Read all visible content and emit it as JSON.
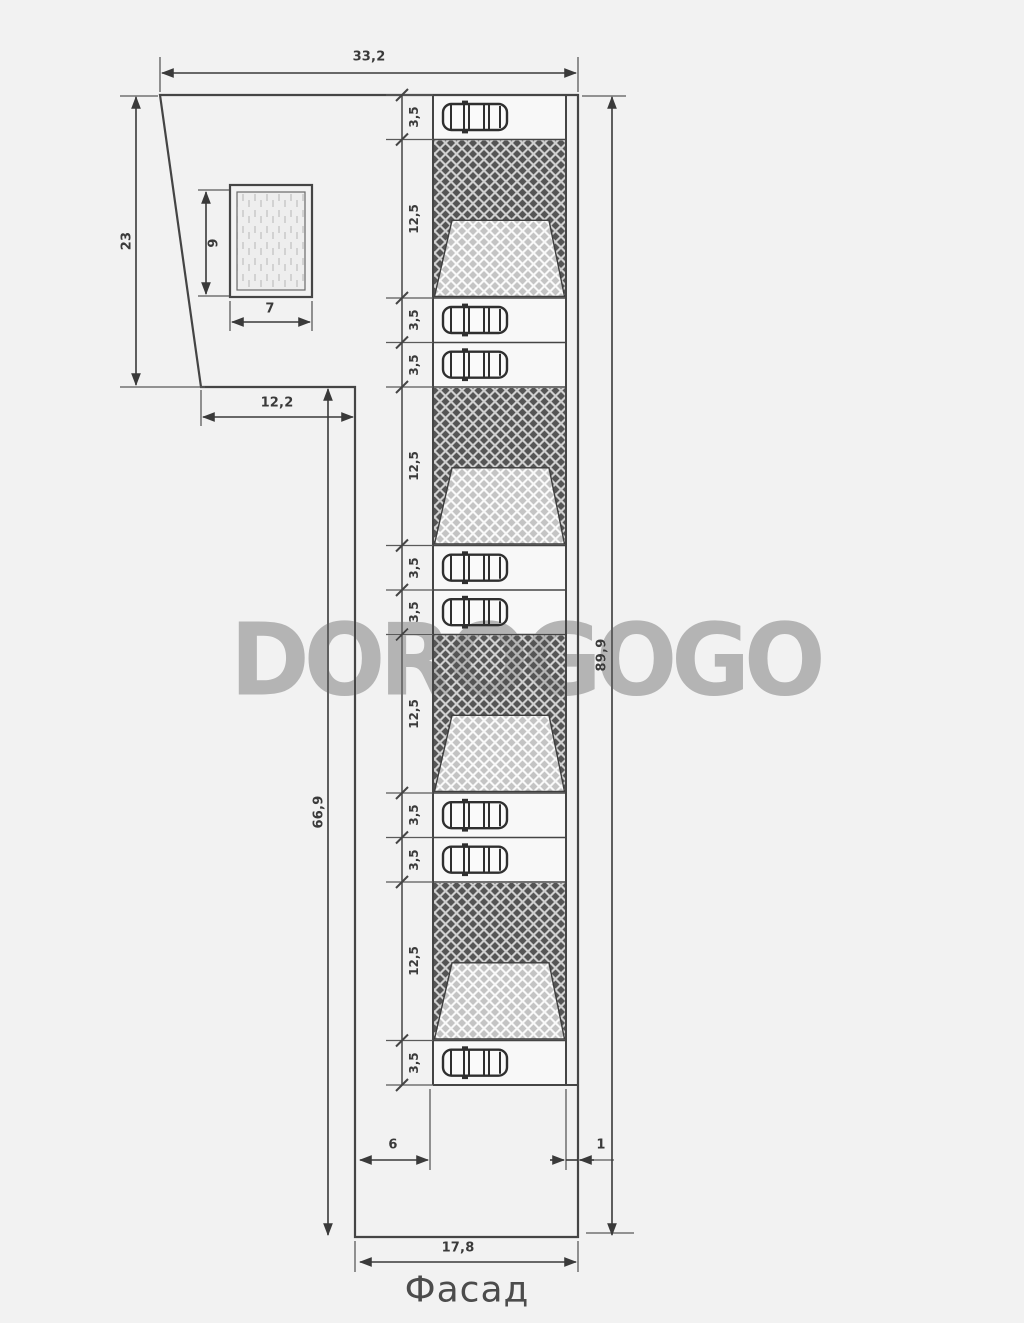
{
  "drawing": {
    "title": "Фасад",
    "watermark": "DOROGOGO",
    "dimensions": {
      "top_width": "33,2",
      "left_upper": "23",
      "step_width": "12,2",
      "left_lower": "66,9",
      "right_total": "89,9",
      "rect_height": "9",
      "rect_width": "7",
      "offset_left": "6",
      "offset_right": "1",
      "bottom_width": "17,8"
    },
    "strip": {
      "cells": [
        {
          "label": "3,5"
        },
        {
          "label": "12,5"
        },
        {
          "label": "3,5"
        },
        {
          "label": "3,5"
        },
        {
          "label": "12,5"
        },
        {
          "label": "3,5"
        },
        {
          "label": "3,5"
        },
        {
          "label": "12,5"
        },
        {
          "label": "3,5"
        },
        {
          "label": "3,5"
        },
        {
          "label": "12,5"
        },
        {
          "label": "3,5"
        }
      ]
    },
    "colors": {
      "background": "#f2f2f2",
      "line": "#454545",
      "dark_hatch": "#555555",
      "light_hatch": "#c4c4c4",
      "watermark": "#b4b4b4"
    }
  }
}
